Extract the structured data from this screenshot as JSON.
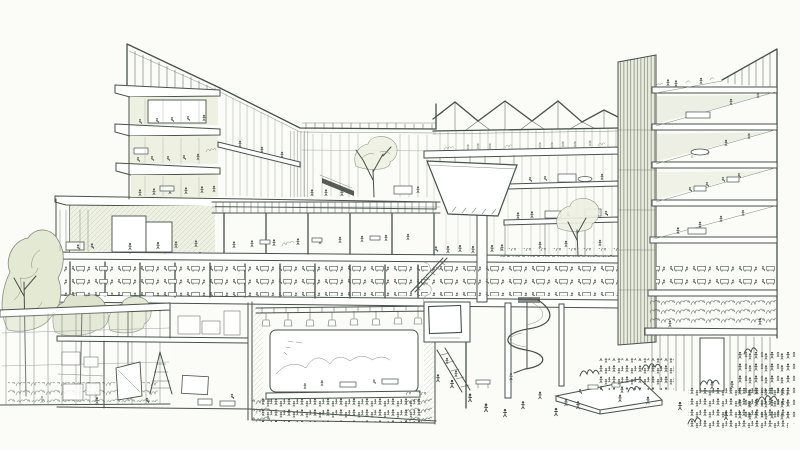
{
  "meta": {
    "title": "Hand-drawn architectural sectional perspective sketch of a multi-storey public building",
    "medium": "Pencil line drawing with light green-grey wash on white paper",
    "style": "cutaway section-perspective, crowded with tiny human figures"
  },
  "colors": {
    "paper": "#fbfbf7",
    "ink": "#48524a",
    "ink_light": "#828c7c",
    "glass_tint": "#e9ecdc",
    "shade_tint": "#d9dfcb",
    "wash": "#eef0e2",
    "dark": "#39413a",
    "foliage": "#e4e9d4",
    "foliage2": "#dde3cc"
  },
  "scene": {
    "regions": [
      {
        "name": "left-tower",
        "desc": "Four-storey cantilevered tower with sloping rooftop clerestory and office interiors"
      },
      {
        "name": "west-connector",
        "desc": "Two-storey glazed link with interior tree and escalator"
      },
      {
        "name": "roof-trellis",
        "desc": "Open pergola trellis over first-floor terrace"
      },
      {
        "name": "sawtooth-roof",
        "desc": "Four-gable truss skylight roof over centre block"
      },
      {
        "name": "atrium-funnel-canopy",
        "desc": "Suspended white funnel canopy over central atrium"
      },
      {
        "name": "core-tower",
        "desc": "Dark vertically-striped circulation core"
      },
      {
        "name": "east-wing",
        "desc": "Tall wing cut in section with receding floor wedges and rooftop figures"
      },
      {
        "name": "mid-level-cafe",
        "desc": "Double band of cafe floors full of tables and people"
      },
      {
        "name": "basement-theater",
        "desc": "Underground performance hall with stage, rigging and audience"
      },
      {
        "name": "basement-studio",
        "desc": "Workshop rooms with ladder, canvases and stored boxes"
      },
      {
        "name": "garden-pavilion",
        "desc": "Glazed pavilion with trees behind, lower left"
      },
      {
        "name": "spiral-slide",
        "desc": "Helical slide dropping from first floor to the plaza"
      },
      {
        "name": "plaza-crowds",
        "desc": "Crowds, bushes and a triangular platform on the ground plaza"
      }
    ]
  }
}
